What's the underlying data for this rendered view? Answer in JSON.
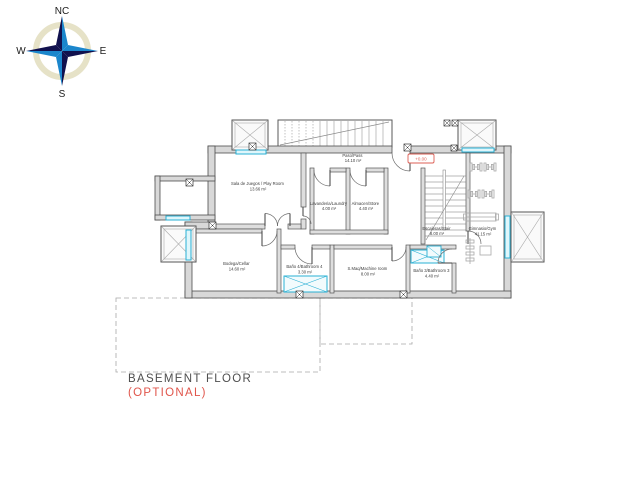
{
  "compass": {
    "north": "NC",
    "east": "E",
    "south": "S",
    "west": "W"
  },
  "plan": {
    "level_marker": "+0.00",
    "rooms": [
      {
        "id": "playroom",
        "name": "Sala de Juegos / Play Room",
        "area": "13.66 m²"
      },
      {
        "id": "paso",
        "name": "Paso/Pass",
        "area": "14.10 m²"
      },
      {
        "id": "laundry",
        "name": "Lavanderia/Laundry",
        "area": "4.00 m²"
      },
      {
        "id": "store",
        "name": "Almacen/Store",
        "area": "4.40 m²"
      },
      {
        "id": "stairs",
        "name": "Escaleras/Stair",
        "area": "8.00 m²"
      },
      {
        "id": "gym",
        "name": "Gimnasio/Gym",
        "area": "41.15 m²"
      },
      {
        "id": "cellar",
        "name": "Bodega/Cellar",
        "area": "14.60 m²"
      },
      {
        "id": "bathroom4",
        "name": "Baño 4/Bathroom 4",
        "area": "3.30 m²"
      },
      {
        "id": "machine",
        "name": "S.Maq/Machine room",
        "area": "8.00 m²"
      },
      {
        "id": "bathroom3",
        "name": "Baño 3/Bathroom 3",
        "area": "4.40 m²"
      }
    ]
  },
  "title": {
    "line1": "BASEMENT FLOOR",
    "line2": "(OPTIONAL)"
  },
  "colors": {
    "wall_fill": "#d8d8d8",
    "wall_line": "#4d4d4d",
    "window_cyan": "#29b0d4",
    "accent_red": "#dd5f55",
    "equipment_gray": "#a8a8a8",
    "compass_blue": "#1b86cc",
    "compass_dark": "#11114e"
  }
}
